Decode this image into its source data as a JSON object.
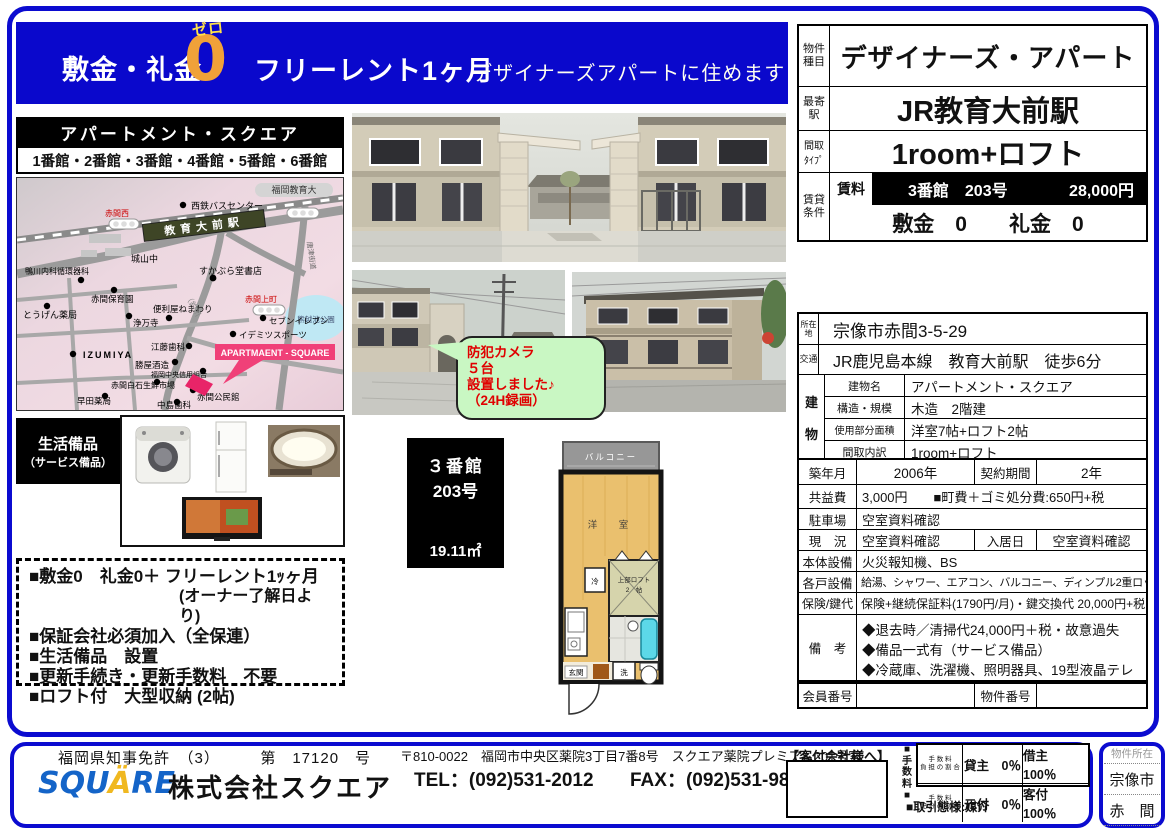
{
  "colors": {
    "frame_blue": "#0b0bd0",
    "banner_blue": "#0a08cc",
    "zero_orange": "#f0a139",
    "bubble_green": "#c9f7c3",
    "alert_red": "#e00000",
    "map_pink": "#f04078"
  },
  "banner": {
    "shikirei": "敷金・礼金",
    "zero_kana": "ゼロ",
    "zero_digit": "0",
    "free_rent": "フリーレント1ヶ月",
    "subtitle": "デザイナーズアパートに住めます"
  },
  "summary": {
    "type_label": "物件種目",
    "type_value": "デザイナーズ・アパート",
    "station_label": "最寄駅",
    "station_value": "JR教育大前駅",
    "madori_label1": "間取",
    "madori_label2": "ﾀｲﾌﾟ",
    "madori_value": "1room+ロフト",
    "rental_label": "賃貸条件",
    "rent_label": "賃料",
    "rent_unit": "3番館　203号",
    "rent_price": "28,000円",
    "deposit_line": "敷金　0　　礼金　0"
  },
  "complex": {
    "title": "アパートメント・スクエア",
    "buildings": "1番館・2番館・3番館・4番館・5番館・6番館"
  },
  "map": {
    "labels": {
      "university": "福岡教育大",
      "bus_center": "西鉄バスセンター",
      "akama_nishi": "赤間西",
      "station": "教育大前駅",
      "shiroyama": "城山中",
      "bookstore": "すかぶら堂書店",
      "akama_kamimachi": "赤間上町",
      "park": "熊越池公園",
      "kamogawa": "鴨川内科循環器科",
      "hoikuen": "赤間保育園",
      "tougen": "とうげん薬局",
      "joumanji": "浄万寺",
      "benriya": "便利屋ねまわり",
      "seven": "セブンイレブン",
      "idemitsu": "イデミツスポーツ",
      "izumiya": "IZUMIYA",
      "etou": "江藤歯科",
      "katsuya": "勝屋酒造",
      "shinyou": "福岡中央信用組合",
      "apartment_square": "APARTMAENT - SQUARE",
      "market": "赤間白石生鮮市場",
      "hayata": "早田薬局",
      "nakashima": "中島歯科",
      "kouminkan": "赤間公民館",
      "river": "（釣川",
      "kaido": "唐津街道"
    }
  },
  "equipment": {
    "line1": "生活備品",
    "line2": "（サービス備品）"
  },
  "bubble": {
    "line1": "防犯カメラ",
    "line2": "５台",
    "line3": "設置しました♪",
    "line4": "（24H録画）"
  },
  "notes": {
    "item1": "■敷金0　礼金0＋ フリーレント1ｯヶ月",
    "item1b": "(オーナー了解日より)",
    "item2": "■保証会社必須加入（全保連）",
    "item3": "■生活備品　設置",
    "item4": "■更新手続き・更新手数料　不要",
    "item5": "■ロフト付　大型収納 (2帖)"
  },
  "unitbox": {
    "building": "３番館",
    "room": "203号",
    "area": "19.11㎡"
  },
  "floorplan": {
    "balcony": "バルコニー",
    "room": "洋　室",
    "loft1": "上部ロフト",
    "loft2": "2　帖",
    "fridge": "冷",
    "entrance": "玄関",
    "washer": "洗"
  },
  "details": {
    "location_label": "所在地",
    "location": "宗像市赤間3-5-29",
    "access_label": "交通",
    "access": "JR鹿児島本線　教育大前駅　徒歩6分",
    "building_label": "建物",
    "bname_label": "建物名",
    "bname": "アパートメント・スクエア",
    "structure_label": "構造・規模",
    "structure": "木造　2階建",
    "area_label": "使用部分面積",
    "area": "洋室7帖+ロフト2帖",
    "madori_label": "間取内訳",
    "madori": "1room+ロフト",
    "built_label": "築年月",
    "built": "2006年",
    "contract_label": "契約期間",
    "contract": "2年",
    "kyoueki_label": "共益費",
    "kyoueki": "3,000円　　■町費＋ゴミ処分費:650円+税",
    "parking_label": "駐車場",
    "parking": "空室資料確認",
    "genkyo_label": "現　況",
    "genkyo": "空室資料確認",
    "nyukyo_label": "入居日",
    "nyukyo": "空室資料確認",
    "main_equip_label": "本体設備",
    "main_equip": "火災報知機、BS",
    "unit_equip_label": "各戸設備",
    "unit_equip": "給湯、シャワー、エアコン、バルコニー、ディンプル2重ロック、1口コンロ",
    "insurance_label": "保険/鍵代",
    "insurance": "保険+継続保証料(1790円/月)・鍵交換代 20,000円+税",
    "biko_label": "備　考",
    "biko1": "◆退去時／清掃代24,000円＋税・故意過失",
    "biko2": "◆備品一式有（サービス備品）",
    "biko3": "◆冷蔵庫、洗濯機、照明器具、19型液晶テレビ",
    "member_label": "会員番号",
    "member_value": "",
    "bukken_label": "物件番号",
    "bukken_value": ""
  },
  "footer": {
    "license": "福岡県知事免許　（3）　　　第　17120　号",
    "logo_part1": "SQU",
    "logo_part2": "Ä",
    "logo_part3": "RE",
    "company": "株式会社スクエア",
    "address": "〒810-0022　福岡市中央区薬院3丁目7番8号　スクエア薬院プレミアム201号室",
    "tel": "TEL：(092)531-2012",
    "fax": "FAX：(092)531-9850",
    "kyakuzuke": "【客付会社様へ】",
    "fee_heading": "■手数料■",
    "fee_r1_l1": "手 数 料",
    "fee_r1_l2": "負 担 の 割 合",
    "fee_r2_l1": "手 数 料",
    "fee_r2_l2": "配 分 の 割 合",
    "fee_lessor": "貸主　0％",
    "fee_lessee": "借主　100％",
    "fee_motozuke": "元付　0％",
    "fee_kyakuzuke": "客付　100％",
    "transaction": "■取引態様:媒介",
    "location_title": "物件所在",
    "location_city": "宗像市",
    "location_town": "赤　間"
  }
}
